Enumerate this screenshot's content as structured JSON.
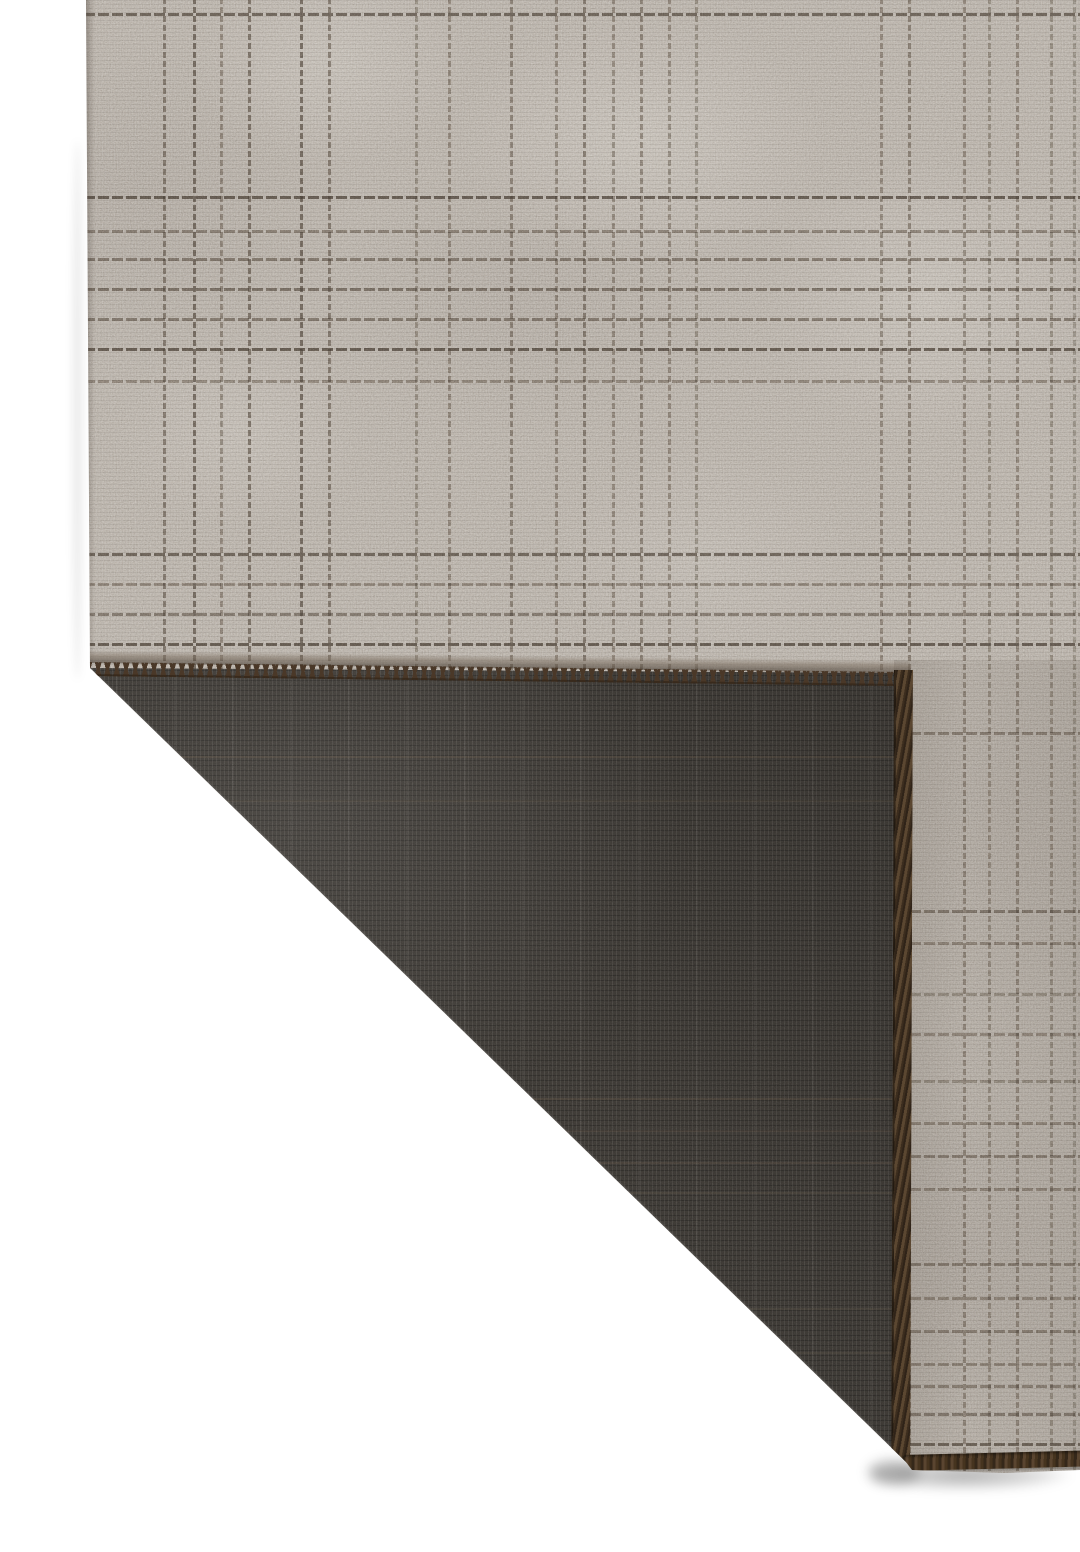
{
  "scene": {
    "type": "product-photo",
    "subject": "Corner of a flatweave plaid rug folded back to show its charcoal woven backing on a white studio background",
    "background_color": "#ffffff"
  },
  "rug": {
    "front": {
      "base_color": "#b9b0a5",
      "light_color": "#cfc8bd",
      "dark_color": "#a79d92",
      "grid_line_color": "#443c34",
      "h_lines": [
        [
          13,
          0.75
        ],
        [
          196,
          0.8
        ],
        [
          230,
          0.55
        ],
        [
          258,
          0.6
        ],
        [
          288,
          0.65
        ],
        [
          318,
          0.6
        ],
        [
          348,
          0.8
        ],
        [
          380,
          0.5
        ],
        [
          553,
          0.75
        ],
        [
          583,
          0.5
        ],
        [
          613,
          0.6
        ],
        [
          643,
          0.8
        ],
        [
          732,
          0.55
        ],
        [
          910,
          0.6
        ],
        [
          942,
          0.5
        ],
        [
          993,
          0.45
        ],
        [
          1033,
          0.5
        ],
        [
          1080,
          0.45
        ],
        [
          1122,
          0.5
        ],
        [
          1155,
          0.55
        ],
        [
          1188,
          0.5
        ],
        [
          1263,
          0.55
        ],
        [
          1297,
          0.5
        ],
        [
          1330,
          0.55
        ],
        [
          1363,
          0.5
        ],
        [
          1385,
          0.55
        ],
        [
          1413,
          0.6
        ],
        [
          1443,
          0.75
        ]
      ],
      "v_lines": [
        [
          163,
          0.6
        ],
        [
          193,
          0.7
        ],
        [
          220,
          0.5
        ],
        [
          248,
          0.65
        ],
        [
          300,
          0.7
        ],
        [
          328,
          0.6
        ],
        [
          415,
          0.45
        ],
        [
          448,
          0.5
        ],
        [
          510,
          0.55
        ],
        [
          555,
          0.5
        ],
        [
          583,
          0.6
        ],
        [
          612,
          0.5
        ],
        [
          640,
          0.55
        ],
        [
          668,
          0.5
        ],
        [
          695,
          0.45
        ],
        [
          880,
          0.5
        ],
        [
          908,
          0.55
        ],
        [
          963,
          0.5
        ],
        [
          988,
          0.45
        ],
        [
          1016,
          0.5
        ],
        [
          1050,
          0.45
        ],
        [
          1073,
          0.4
        ]
      ]
    },
    "back": {
      "base_color": "#36332f",
      "speck_color": "#57524b",
      "ghost_line_color": "#6a5b48",
      "ghost_h_lines": [
        [
          756,
          0.2
        ],
        [
          800,
          0.16
        ],
        [
          1098,
          0.2
        ],
        [
          1130,
          0.18
        ],
        [
          1162,
          0.18
        ],
        [
          1192,
          0.16
        ],
        [
          1308,
          0.15
        ],
        [
          1352,
          0.15
        ]
      ]
    },
    "edges": {
      "stitch_color": "#4a3828",
      "serge_color": "#5b4731",
      "binding_color": "#5a4530"
    },
    "geometry": {
      "silhouette": [
        [
          86,
          0
        ],
        [
          1080,
          0
        ],
        [
          1080,
          1470
        ],
        [
          1005,
          1473
        ],
        [
          912,
          1470
        ],
        [
          906,
          1462
        ],
        [
          90,
          668
        ]
      ],
      "flap": [
        [
          90,
          668
        ],
        [
          907,
          673
        ],
        [
          906,
          1462
        ]
      ],
      "stitch_top": {
        "x": 86,
        "y": 662,
        "w": 824,
        "h": 14,
        "angle": 0.7
      },
      "fold_roll": {
        "x": 86,
        "y": 650,
        "w": 824,
        "h": 13,
        "angle": 0.7
      },
      "serge_right": {
        "x": 894,
        "y": 670,
        "w": 17,
        "h": 794,
        "angle": 0.2
      },
      "binding_bottom": {
        "x": 903,
        "y": 1455,
        "w": 184,
        "h": 16,
        "angle": -1.4
      },
      "fold_highlight": {
        "x": 88,
        "y": 666,
        "w": 1140,
        "h": 3,
        "angle": 44.2
      }
    }
  }
}
